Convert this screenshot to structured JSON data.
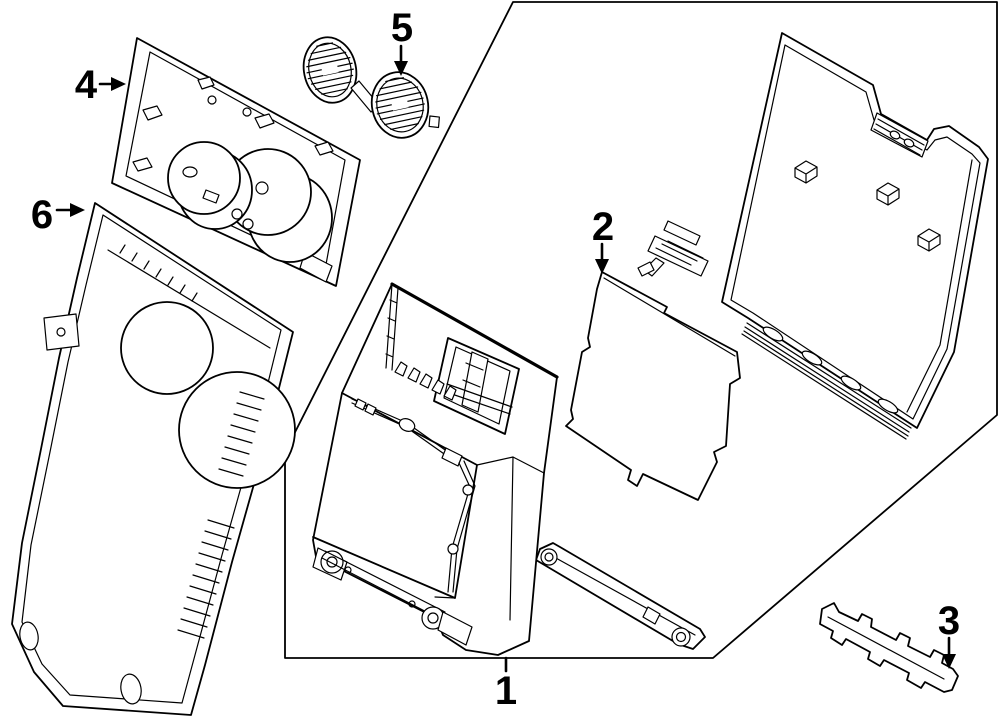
{
  "figure": {
    "type": "exploded parts diagram",
    "background_color": "#ffffff",
    "line_color": "#000000",
    "callouts": [
      {
        "number": "1"
      },
      {
        "number": "2"
      },
      {
        "number": "3"
      },
      {
        "number": "4"
      },
      {
        "number": "5"
      },
      {
        "number": "6"
      }
    ]
  }
}
